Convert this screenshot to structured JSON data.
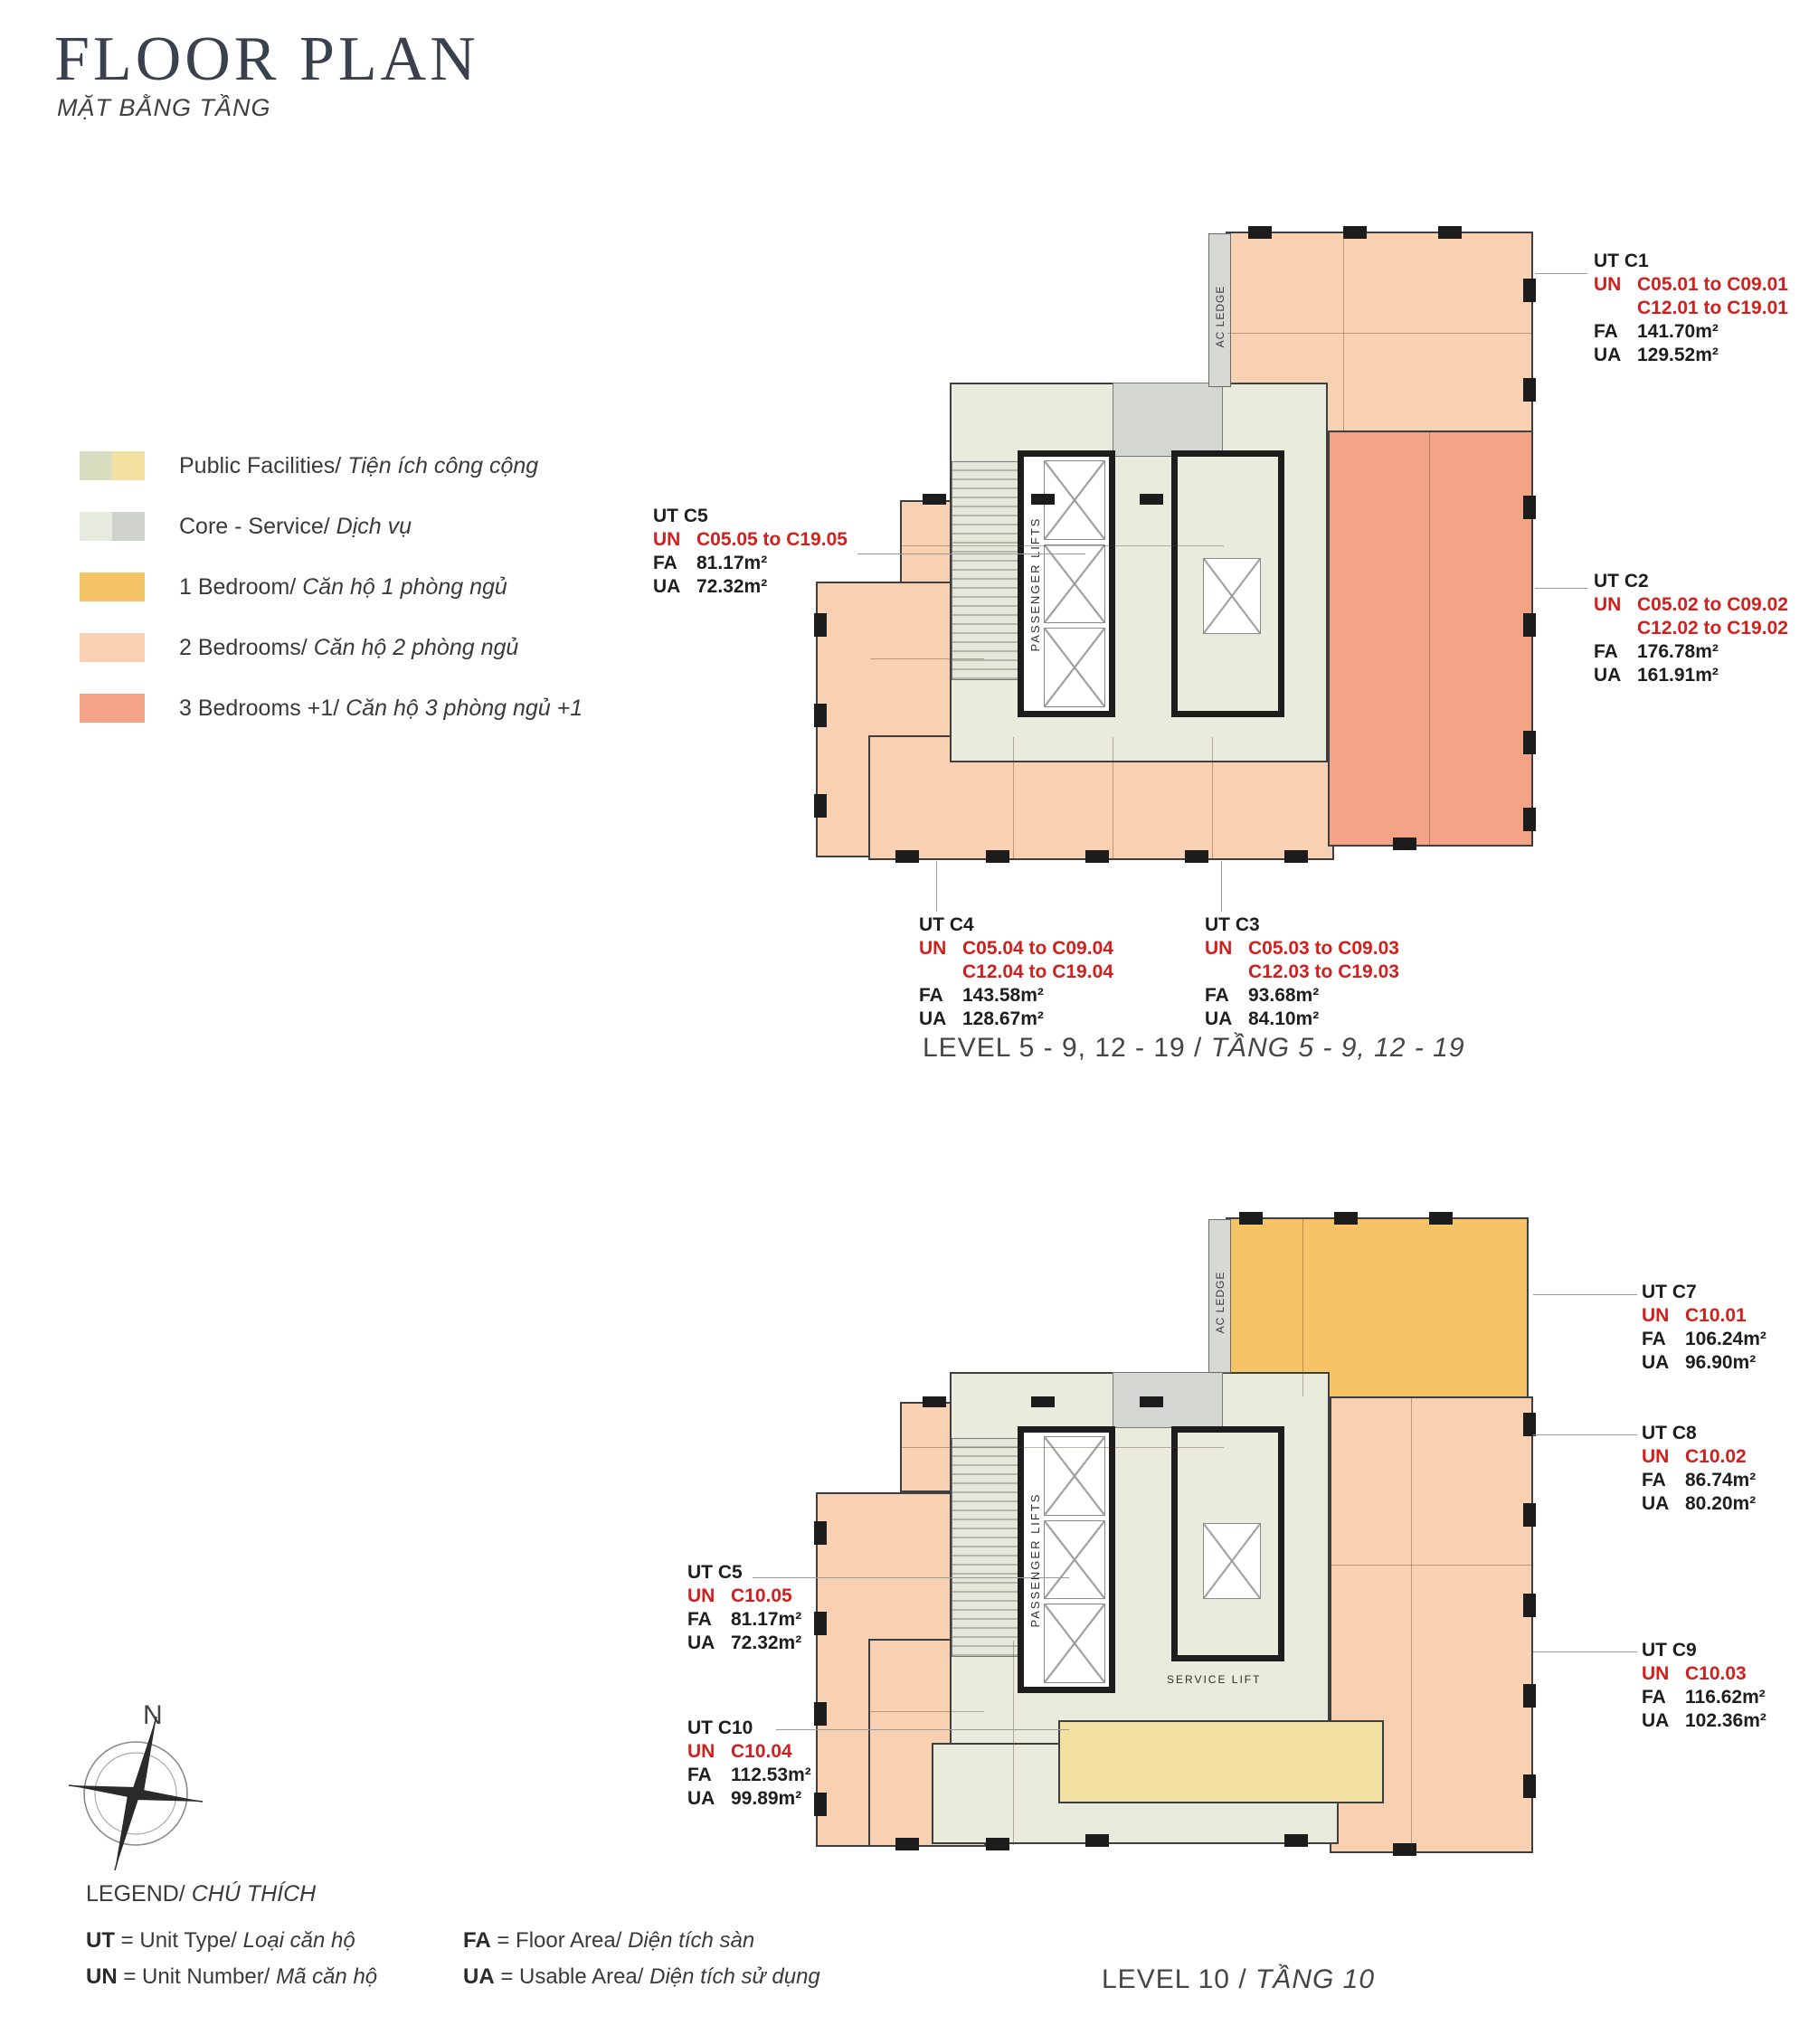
{
  "header": {
    "title": "FLOOR PLAN",
    "subtitle": "MẶT BẰNG TẦNG"
  },
  "legend": {
    "items": [
      {
        "en": "Public Facilities/",
        "vi": "Tiện ích công cộng",
        "c1": "#d9ddc0",
        "c2": "#f3df9f"
      },
      {
        "en": "Core - Service/",
        "vi": "Dịch vụ",
        "c1": "#e7eadf",
        "c2": "#cfd1cd"
      },
      {
        "en": "1 Bedroom/",
        "vi": "Căn hộ 1 phòng ngủ",
        "c1": "#f5c466",
        "c2": "#f5c466"
      },
      {
        "en": "2 Bedrooms/",
        "vi": "Căn hộ 2 phòng ngủ",
        "c1": "#f8d1b2",
        "c2": "#f8d1b2"
      },
      {
        "en": "3 Bedrooms +1/",
        "vi": "Căn hộ 3 phòng ngủ +1",
        "c1": "#f3a486",
        "c2": "#f3a486"
      }
    ]
  },
  "plan_labels": {
    "ac_ledge": "AC LEDGE",
    "passenger_lifts": "PASSENGER LIFTS",
    "service_lift": "SERVICE LIFT",
    "north": "N"
  },
  "abbr": {
    "ut": "UT",
    "un": "UN",
    "fa": "FA",
    "ua": "UA"
  },
  "units": {
    "c1": {
      "ut": "UT C1",
      "un1": "C05.01 to C09.01",
      "un2": "C12.01 to C19.01",
      "fa": "141.70m²",
      "ua": "129.52m²"
    },
    "c2": {
      "ut": "UT C2",
      "un1": "C05.02 to C09.02",
      "un2": "C12.02 to C19.02",
      "fa": "176.78m²",
      "ua": "161.91m²"
    },
    "c3": {
      "ut": "UT C3",
      "un1": "C05.03 to C09.03",
      "un2": "C12.03 to C19.03",
      "fa": "93.68m²",
      "ua": "84.10m²"
    },
    "c4": {
      "ut": "UT C4",
      "un1": "C05.04 to C09.04",
      "un2": "C12.04 to C19.04",
      "fa": "143.58m²",
      "ua": "128.67m²"
    },
    "c5u": {
      "ut": "UT C5",
      "un1": "C05.05 to C19.05",
      "fa": "81.17m²",
      "ua": "72.32m²"
    },
    "c7": {
      "ut": "UT C7",
      "un1": "C10.01",
      "fa": "106.24m²",
      "ua": "96.90m²"
    },
    "c8": {
      "ut": "UT C8",
      "un1": "C10.02",
      "fa": "86.74m²",
      "ua": "80.20m²"
    },
    "c9": {
      "ut": "UT C9",
      "un1": "C10.03",
      "fa": "116.62m²",
      "ua": "102.36m²"
    },
    "c5l": {
      "ut": "UT C5",
      "un1": "C10.05",
      "fa": "81.17m²",
      "ua": "72.32m²"
    },
    "c10": {
      "ut": "UT C10",
      "un1": "C10.04",
      "fa": "112.53m²",
      "ua": "99.89m²"
    }
  },
  "captions": {
    "upper_en": "LEVEL 5 - 9, 12 - 19 /",
    "upper_vi": "TẦNG 5 - 9, 12 - 19",
    "lower_en": "LEVEL 10 /",
    "lower_vi": "TẦNG 10"
  },
  "footer": {
    "legend_title_en": "LEGEND/",
    "legend_title_vi": "CHÚ THÍCH",
    "defs": [
      {
        "abbr": "UT",
        "en": "= Unit Type/",
        "vi": "Loại căn hộ"
      },
      {
        "abbr": "UN",
        "en": "= Unit Number/",
        "vi": "Mã căn hộ"
      },
      {
        "abbr": "FA",
        "en": "= Floor Area/",
        "vi": "Diện tích sàn"
      },
      {
        "abbr": "UA",
        "en": "= Usable Area/",
        "vi": "Diện tích sử dụng"
      }
    ]
  }
}
